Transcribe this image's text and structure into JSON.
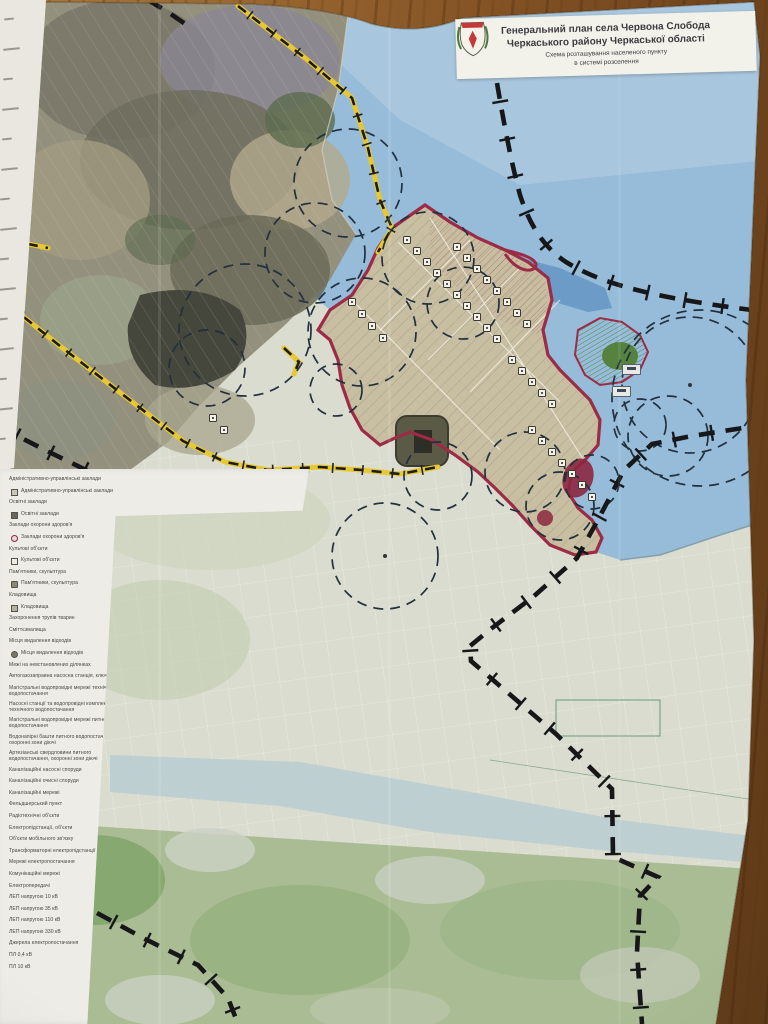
{
  "document": {
    "kind": "printed-map-photo",
    "title_block": {
      "line1": "Генеральний план села Червона Слобода",
      "line2": "Черкаського району Черкаської області",
      "subtitle1": "Схема розташування населеного пункту",
      "subtitle2": "в системі розселення"
    }
  },
  "legend": {
    "rows": [
      {
        "icon": "none",
        "text": "Адміністративно-управлінські заклади"
      },
      {
        "icon": "building",
        "text": "Адміністративно-управлінські заклади"
      },
      {
        "icon": "none",
        "text": "Освітні заклади"
      },
      {
        "icon": "school",
        "text": "Освітні заклади"
      },
      {
        "icon": "none",
        "text": "Заклади охорони здоров'я"
      },
      {
        "icon": "medical",
        "text": "Заклади охорони здоров'я"
      },
      {
        "icon": "none",
        "text": "Культові об'єкти"
      },
      {
        "icon": "church",
        "text": "Культові об'єкти"
      },
      {
        "icon": "none",
        "text": "Пам'ятники, скульптура"
      },
      {
        "icon": "monument",
        "text": "Пам'ятники, скульптура"
      },
      {
        "icon": "none",
        "text": "Кладовища"
      },
      {
        "icon": "cemetery",
        "text": "Кладовища"
      },
      {
        "icon": "none",
        "text": "Захоронення трупів тварин"
      },
      {
        "icon": "none",
        "text": "Сміттєзвалища"
      },
      {
        "icon": "none",
        "text": "Місця видалення відходів"
      },
      {
        "icon": "waste",
        "text": "Місця видалення відходів"
      },
      {
        "icon": "none",
        "text": "Межі на невстановлених ділянках"
      },
      {
        "icon": "none",
        "text": "Автогазозаправна насосна станція, ключова"
      },
      {
        "icon": "none",
        "text": "Магістральні водопровідні мережі технічного водопостачання"
      },
      {
        "icon": "none",
        "text": "Насосні станції та водопровідні комплекси технічного водопостачання"
      },
      {
        "icon": "none",
        "text": "Магістральні водопровідні мережі питного водопостачання"
      },
      {
        "icon": "none",
        "text": "Водонапірні башти питного водопостачання, охоронні зони діючі"
      },
      {
        "icon": "none",
        "text": "Артезіанські свердловини питного водопостачання, охоронні зони діючі"
      },
      {
        "icon": "none",
        "text": "Каналізаційні насосні споруди"
      },
      {
        "icon": "none",
        "text": "Каналізаційні очисні споруди"
      },
      {
        "icon": "none",
        "text": "Каналізаційні мережі"
      },
      {
        "icon": "none",
        "text": "Фельдшерський пункт"
      },
      {
        "icon": "none",
        "text": "Радіотехнічні об'єкти"
      },
      {
        "icon": "none",
        "text": "Електропідстанції, об'єкти"
      },
      {
        "icon": "none",
        "text": "Об'єкти мобільного зв'язку"
      },
      {
        "icon": "none",
        "text": "Трансформаторні електропідстанції"
      },
      {
        "icon": "none",
        "text": "Мережі електропостачання"
      },
      {
        "icon": "none",
        "text": "Комунікаційні мережі"
      },
      {
        "icon": "none",
        "text": "Електропередачі"
      },
      {
        "icon": "none",
        "text": "ЛЕП напругою 10 кВ"
      },
      {
        "icon": "none",
        "text": "ЛЕП напругою 35 кВ"
      },
      {
        "icon": "none",
        "text": "ЛЕП напругою 110 кВ"
      },
      {
        "icon": "none",
        "text": "ЛЕП напругою 330 кВ"
      },
      {
        "icon": "none",
        "text": "Джерела електропостачання"
      },
      {
        "icon": "none",
        "text": "ПЛ 0,4 кВ"
      },
      {
        "icon": "none",
        "text": "ПЛ 10 кВ"
      }
    ]
  },
  "colors": {
    "wood": "#8a5a2e",
    "paper": "#dfe1d4",
    "water": "#96bcd9",
    "water_deep": "#6495c2",
    "village": "#c8bfa2",
    "fields": "#d9dcce",
    "greenery": "#a9bc93",
    "boundary_red": "#9c2b46",
    "road_yellow": "#e8c832",
    "admin_boundary_black": "#17171a",
    "legend_panel": "#edece6"
  }
}
